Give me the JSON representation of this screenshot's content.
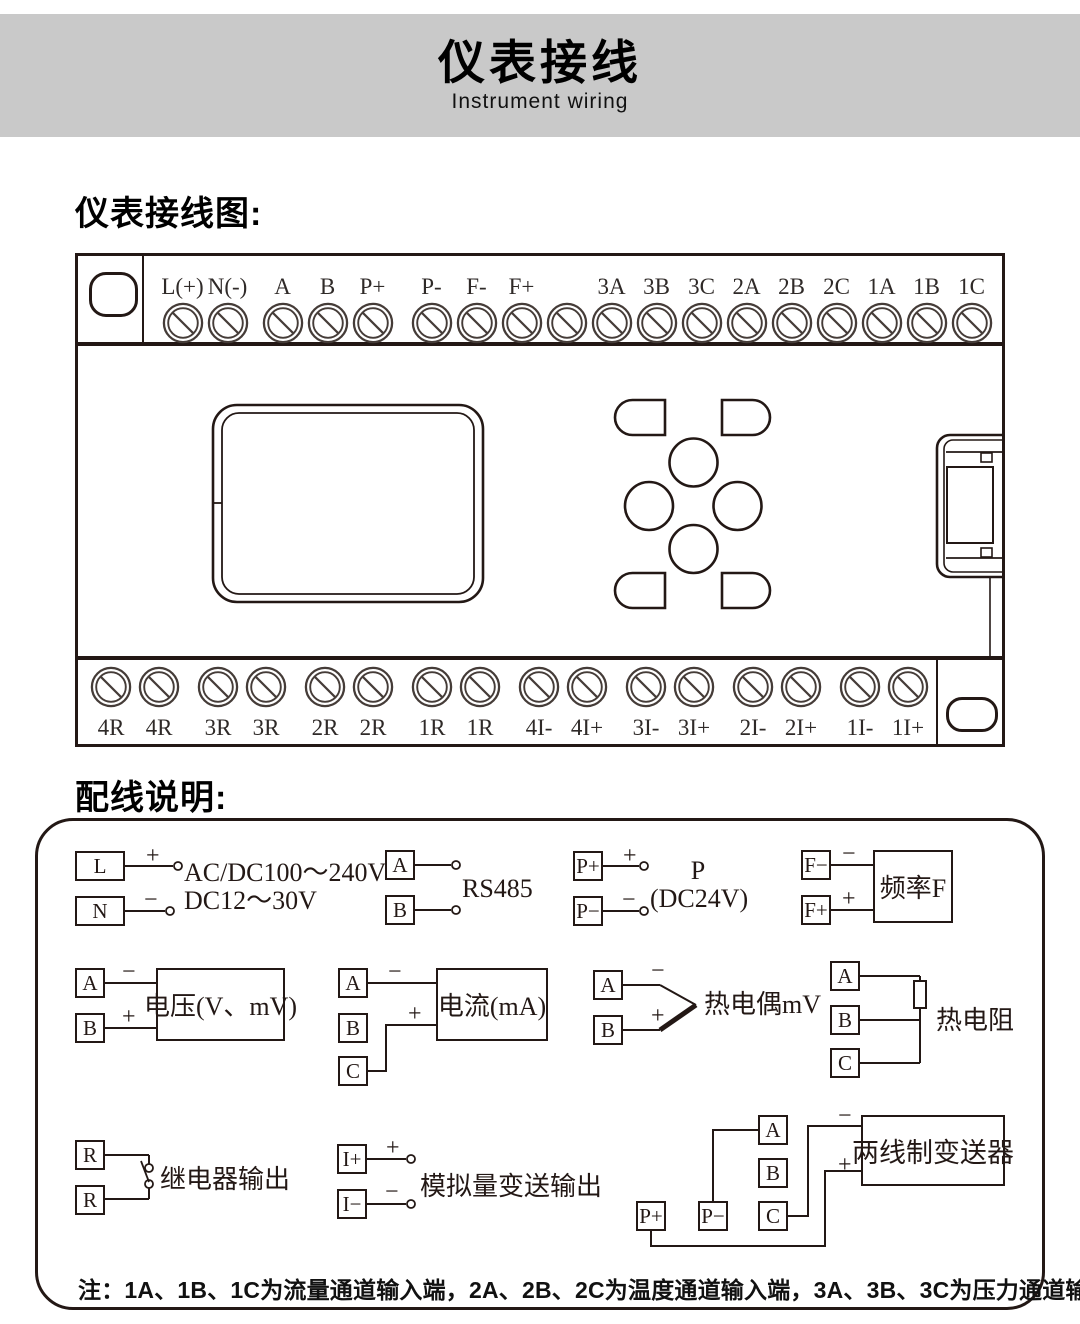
{
  "header": {
    "title": "仪表接线",
    "subtitle": "Instrument wiring"
  },
  "sections": {
    "wiring_diagram_title": "仪表接线图:",
    "wiring_notes_title": "配线说明:"
  },
  "icons": {
    "screw": "screw-terminal-icon"
  },
  "device": {
    "top_terminals": [
      {
        "label": "L(+)"
      },
      {
        "label": "N(-)"
      },
      {
        "label": "A",
        "cls": "gs1"
      },
      {
        "label": "B"
      },
      {
        "label": "P+"
      },
      {
        "label": "P-",
        "cls": "gs2"
      },
      {
        "label": "F-"
      },
      {
        "label": "F+"
      },
      {
        "label": ""
      },
      {
        "label": "3A"
      },
      {
        "label": "3B"
      },
      {
        "label": "3C"
      },
      {
        "label": "2A"
      },
      {
        "label": "2B"
      },
      {
        "label": "2C"
      },
      {
        "label": "1A"
      },
      {
        "label": "1B"
      },
      {
        "label": "1C"
      }
    ],
    "bottom_terminals": [
      {
        "label": "4R"
      },
      {
        "label": "4R"
      },
      {
        "label": "3R",
        "cls": "gs1"
      },
      {
        "label": "3R"
      },
      {
        "label": "2R",
        "cls": "gs1"
      },
      {
        "label": "2R"
      },
      {
        "label": "1R",
        "cls": "gs1"
      },
      {
        "label": "1R"
      },
      {
        "label": "4I-",
        "cls": "gs1"
      },
      {
        "label": "4I+"
      },
      {
        "label": "3I-",
        "cls": "gs1"
      },
      {
        "label": "3I+"
      },
      {
        "label": "2I-",
        "cls": "gs1"
      },
      {
        "label": "2I+"
      },
      {
        "label": "1I-",
        "cls": "gs1"
      },
      {
        "label": "1I+"
      }
    ]
  },
  "wiring": {
    "power": {
      "t1": "L",
      "t2": "N",
      "plus": "+",
      "minus": "−",
      "line1": "AC/DC100～240V",
      "line2": "DC12～30V"
    },
    "rs485": {
      "t1": "A",
      "t2": "B",
      "label": "RS485"
    },
    "p24": {
      "t1": "P+",
      "t2": "P−",
      "plus": "+",
      "minus": "−",
      "line1": "P",
      "line2": "(DC24V)"
    },
    "freq": {
      "t1": "F−",
      "t2": "F+",
      "plus": "+",
      "minus": "−",
      "box": "频率F"
    },
    "voltage": {
      "t1": "A",
      "t2": "B",
      "plus": "+",
      "minus": "−",
      "box": "电压(V、mV)"
    },
    "current": {
      "t1": "A",
      "t2": "B",
      "t3": "C",
      "plus": "+",
      "minus": "−",
      "box": "电流(mA)"
    },
    "thermocouple": {
      "t1": "A",
      "t2": "B",
      "plus": "+",
      "minus": "−",
      "label": "热电偶mV"
    },
    "rtd": {
      "t1": "A",
      "t2": "B",
      "t3": "C",
      "label": "热电阻"
    },
    "relay": {
      "t1": "R",
      "t2": "R",
      "label": "继电器输出"
    },
    "analog_out": {
      "t1": "I+",
      "t2": "I−",
      "plus": "+",
      "minus": "−",
      "label": "模拟量变送输出"
    },
    "two_wire": {
      "p1": "P+",
      "p2": "P−",
      "t1": "A",
      "t2": "B",
      "t3": "C",
      "plus": "+",
      "minus": "−",
      "box": "两线制变送器"
    },
    "note": "注：1A、1B、1C为流量通道输入端，2A、2B、2C为温度通道输入端，3A、3B、3C为压力通道输入端。"
  },
  "colors": {
    "ink": "#231815",
    "band": "#c9c9c9"
  }
}
